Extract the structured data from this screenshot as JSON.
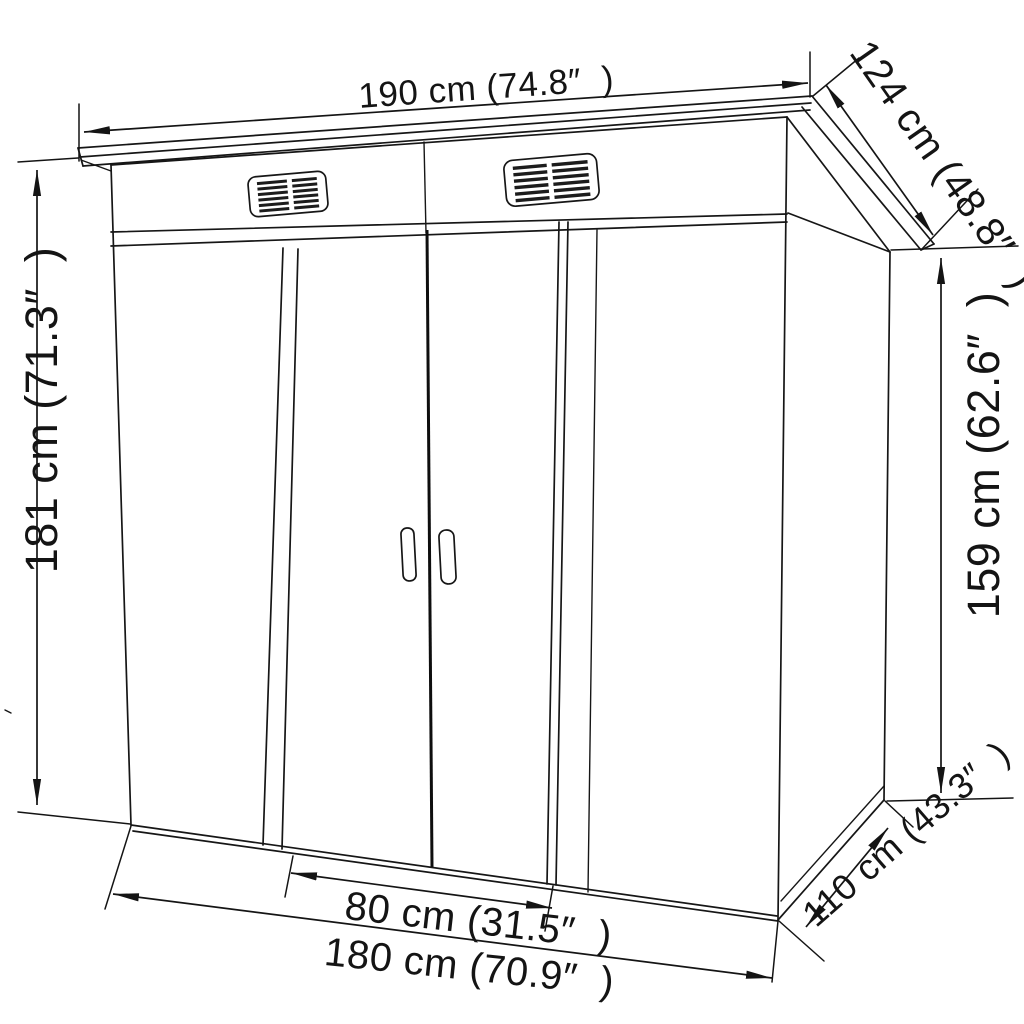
{
  "figure": {
    "kind": "product dimension line-art diagram",
    "subject": "pent-roof garden storage shed with double sliding doors and two louvered vents",
    "background_color": "#ffffff",
    "line_color": "#161616"
  },
  "labels": {
    "width_top": "190 cm (74.8″  )",
    "roof_depth": "124 cm (48.8″  )",
    "height_front": "181 cm (71.3″  )",
    "height_back": "159 cm (62.6″  )",
    "door_width": "80 cm (31.5″  )",
    "width_bottom": "180 cm (70.9″  )",
    "base_depth": "110 cm (43.3″  )"
  },
  "measurements": [
    {
      "name": "overall width at roof (top)",
      "cm": 190,
      "inches": 74.8
    },
    {
      "name": "roof depth (slope, right)",
      "cm": 124,
      "inches": 48.8
    },
    {
      "name": "front height (left)",
      "cm": 181,
      "inches": 71.3
    },
    {
      "name": "back height (right)",
      "cm": 159,
      "inches": 62.6
    },
    {
      "name": "door opening width",
      "cm": 80,
      "inches": 31.5
    },
    {
      "name": "base width (bottom)",
      "cm": 180,
      "inches": 70.9
    },
    {
      "name": "base depth (bottom right)",
      "cm": 110,
      "inches": 43.3
    }
  ]
}
